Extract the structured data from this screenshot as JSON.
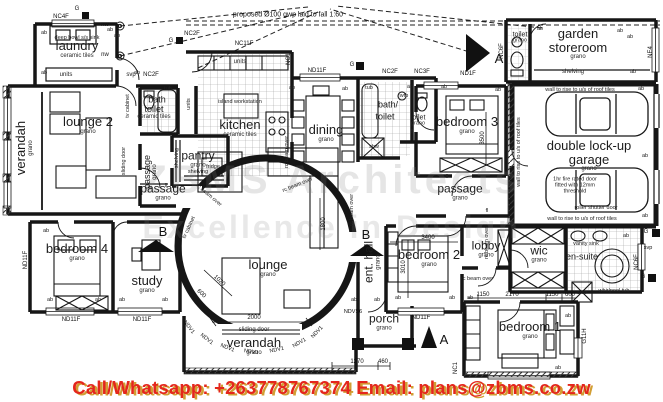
{
  "watermark": {
    "line1": "ZBMS Architects",
    "line2": "Excellence in Design"
  },
  "contact": {
    "text": "Call/Whatsapp: +263778767374  Email: plans@zbms.co.zw"
  },
  "notes": {
    "top_note": "proposed Ø100 gwp laid to fall 1:60",
    "rc_beam": "rc beam over",
    "wall_rise": "wall to rise to u/s of roof tiles",
    "roller_door": "roller shutter door",
    "fire_door": "1hr fire rated door fitted with 12mm threshold"
  },
  "rooms": [
    {
      "name": "laundry",
      "finish": "ceramic tiles"
    },
    {
      "name": "verandah",
      "finish": "grano"
    },
    {
      "name": "lounge 2",
      "finish": "grano"
    },
    {
      "name": "bath",
      "finish": ""
    },
    {
      "name": "toilet",
      "finish": "ceramic tiles"
    },
    {
      "name": "passage",
      "finish": "grano"
    },
    {
      "name": "passage",
      "finish": "grano"
    },
    {
      "name": "pantry",
      "finish": "grano"
    },
    {
      "name": "kitchen",
      "finish": "ceramic tiles"
    },
    {
      "name": "bedroom 4",
      "finish": "grano"
    },
    {
      "name": "study",
      "finish": "grano"
    },
    {
      "name": "lounge",
      "finish": "grano"
    },
    {
      "name": "dining",
      "finish": "grano"
    },
    {
      "name": "bath/",
      "finish": ""
    },
    {
      "name": "toilet",
      "finish": ""
    },
    {
      "name": "toilet",
      "finish": "grano"
    },
    {
      "name": "bedroom 3",
      "finish": "grano"
    },
    {
      "name": "passage",
      "finish": "grano"
    },
    {
      "name": "bedroom 2",
      "finish": "grano"
    },
    {
      "name": "ent. hall",
      "finish": "grano"
    },
    {
      "name": "porch",
      "finish": "grano"
    },
    {
      "name": "verandah",
      "finish": "grano"
    },
    {
      "name": "lobby",
      "finish": "grano"
    },
    {
      "name": "wic",
      "finish": "grano"
    },
    {
      "name": "en-suite",
      "finish": ""
    },
    {
      "name": "bedroom 1",
      "finish": "grano"
    },
    {
      "name": "garden storeroom",
      "finish": "grano"
    },
    {
      "name": "toilet",
      "finish": "grano"
    },
    {
      "name": "double lock-up garage",
      "finish": "grano"
    }
  ],
  "fixtures": {
    "sink": "deep bowl s/s sink",
    "units": "units",
    "island": "island workstation",
    "fridge": "fridge",
    "shelving": "shelving",
    "tub": "tub",
    "shw": "shw",
    "whirlpool": "whirlpool tub",
    "vanity": "vanity sink",
    "tv_cabinet": "tv cabinet",
    "sliding_door": "sliding door",
    "wfb": "wfb"
  },
  "codes": {
    "nc4f": "NC4F",
    "nc11f": "NC11F",
    "nc1": "NC1",
    "nd11f": "ND11F",
    "nc2f": "NC2F",
    "nc3f": "NC3F",
    "nd1f": "ND1F",
    "nc6f": "NC6F",
    "ne4": "NE4",
    "ndv1": "NDV1",
    "ndvs6": "NDVS6",
    "g11h": "G11H",
    "g": "G",
    "ab": "ab",
    "fl": "fl",
    "svp": "svp",
    "nw": "nw"
  },
  "dims": {
    "d2000": "2000",
    "d1800": "1800",
    "d3400": "3400",
    "d3010": "3010",
    "d3500": "3500",
    "d1150": "1150",
    "d2170": "2170",
    "d600": "600",
    "d1270": "1270",
    "d460": "460",
    "d1020": "1020"
  },
  "sections": {
    "a": "A",
    "b": "B"
  }
}
